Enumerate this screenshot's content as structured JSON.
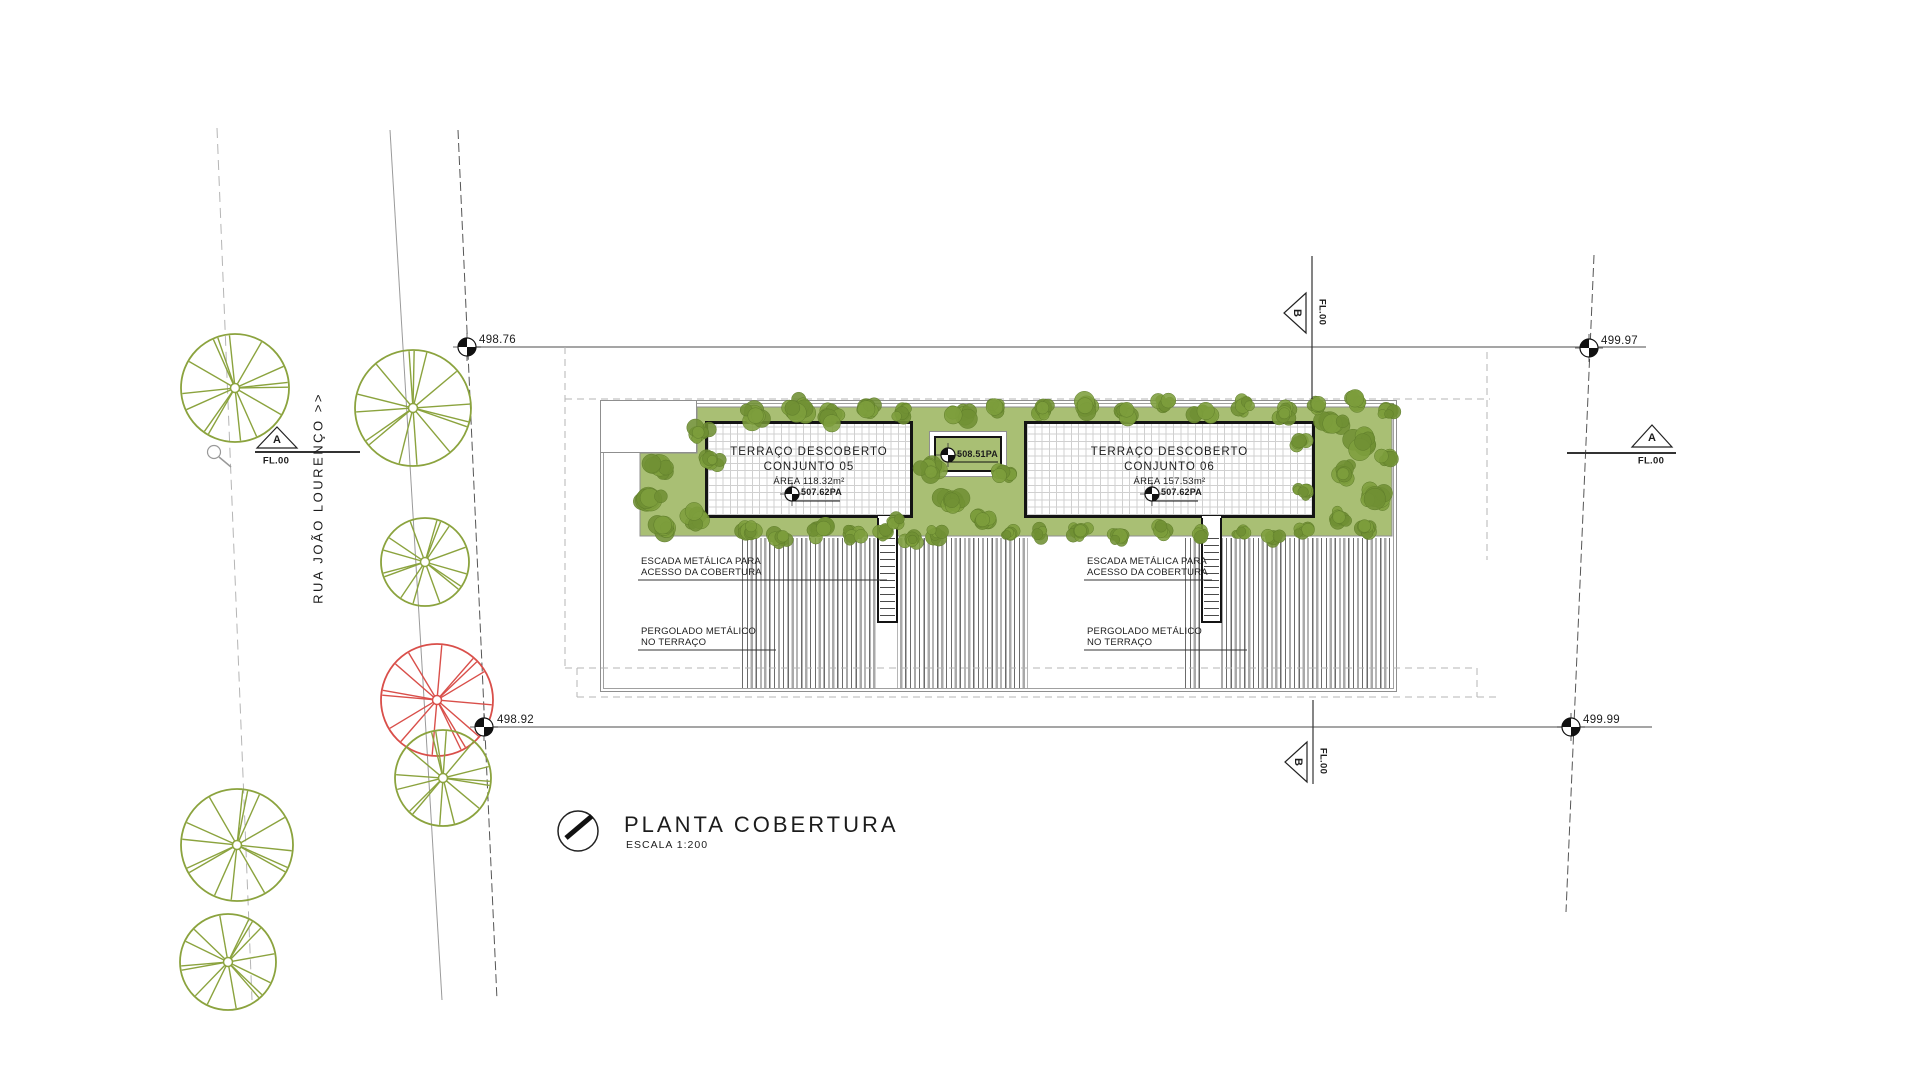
{
  "drawing": {
    "title": "PLANTA COBERTURA",
    "scale": "ESCALA 1:200"
  },
  "street": {
    "name": "RUA JOÃO LOURENÇO >>"
  },
  "survey_points": {
    "top_left": "498.76",
    "bottom_left": "498.92",
    "top_right": "499.97",
    "bottom_right": "499.99"
  },
  "sections": {
    "a_letter": "A",
    "b_letter": "B",
    "level": "FL.00"
  },
  "terraces": {
    "t05": {
      "title_line1": "TERRAÇO DESCOBERTO",
      "title_line2": "CONJUNTO 05",
      "area": "ÁREA 118.32m²",
      "level": "507.62PA"
    },
    "t06": {
      "title_line1": "TERRAÇO DESCOBERTO",
      "title_line2": "CONJUNTO 06",
      "area": "ÁREA 157.53m²",
      "level": "507.62PA"
    }
  },
  "roof_access_level": "508.51PA",
  "annotations": {
    "stair_line1": "ESCADA METÁLICA PARA",
    "stair_line2": "ACESSO DA COBERTURA",
    "pergola_line1": "PERGOLADO METÁLICO",
    "pergola_line2": "NO TERRAÇO"
  },
  "colors": {
    "vegetation_fill": "#a9bf74",
    "foliage_dark": "#7d9e3c",
    "foliage_alt": "#6f9033",
    "tree_stroke": "#8ba33e",
    "red_tree_stroke": "#d94f4a",
    "linework": "#333333",
    "dashed": "#b5b5b5"
  }
}
